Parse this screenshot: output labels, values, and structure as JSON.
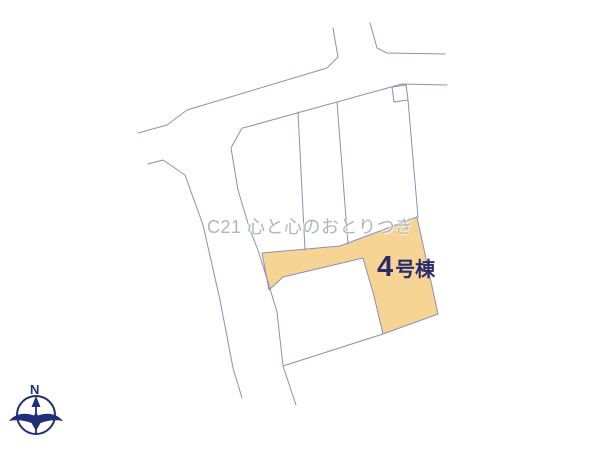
{
  "canvas": {
    "background": "#ffffff"
  },
  "plan": {
    "stroke_color": "#8b90b5",
    "highlight_fill": "#f6d494",
    "lines": [
      {
        "name": "street-upper-left-edge",
        "points": "333,28 338,57 327,68 187,110 167,125 138,133"
      },
      {
        "name": "street-upper-right-edge",
        "points": "370,23 377,48 387,53 445,54"
      },
      {
        "name": "road-lower-edge",
        "points": "243,128 402,84 447,85"
      },
      {
        "name": "road-left-edge",
        "points": "242,128 231,148 238,190 250,230 258,250 268,282 277,312 283,366 296,405"
      },
      {
        "name": "street-left-lower-edge",
        "points": "148,164 163,160 185,175 203,225 220,300 233,368 242,398"
      },
      {
        "name": "parcel-divider-1",
        "points": "298,112 305,250"
      },
      {
        "name": "parcel-divider-2",
        "points": "337,102 348,244"
      },
      {
        "name": "parcel-divider-3",
        "points": "408,100 418,217"
      },
      {
        "name": "inner-parcel-bottom-edge",
        "points": "283,366 383,334"
      }
    ],
    "polygons": [
      {
        "name": "highlight-parcel-4",
        "points": "262,253 340,246 417,217 438,314 383,334 374,296 363,258 283,277 269,290",
        "fill": "#f6d494"
      },
      {
        "name": "survey-marker-square",
        "points": "392,87 406,85 408,100 394,102",
        "fill": "none"
      }
    ],
    "label": {
      "number": "4",
      "suffix": "号棟",
      "color": "#2b2a6b"
    },
    "watermark": {
      "text": "C21 心と心のおとりつぎ",
      "color": "#b2b4c0"
    },
    "compass": {
      "north_label": "N",
      "color": "#1f2f7a"
    }
  }
}
